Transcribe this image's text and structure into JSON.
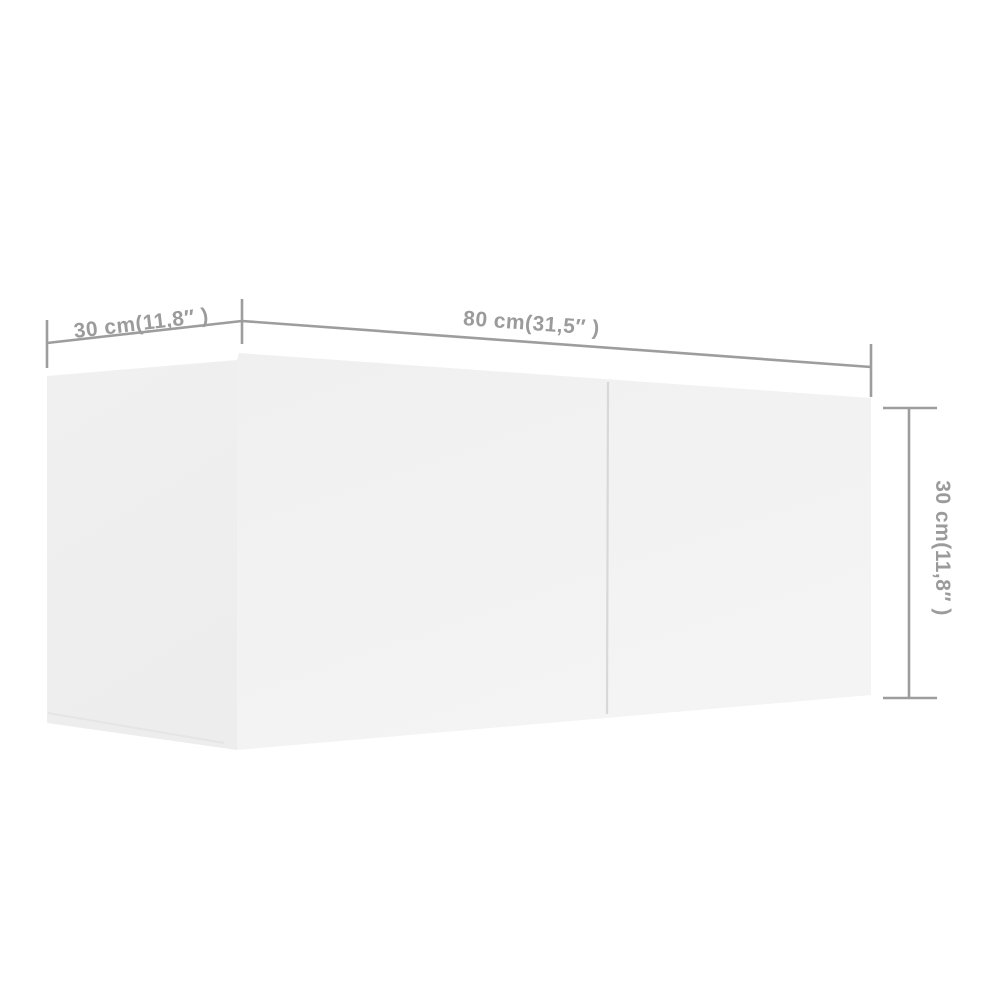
{
  "diagram": {
    "kind": "product-dimension-diagram",
    "dimensions": {
      "depth": {
        "label": "30 cm(11,8″ )",
        "cm": "30",
        "inches": "11,8"
      },
      "width": {
        "label": "80 cm(31,5″ )",
        "cm": "80",
        "inches": "31,5"
      },
      "height": {
        "label": "30 cm(11,8″ )",
        "cm": "30",
        "inches": "11,8"
      }
    },
    "colors": {
      "background": "#ffffff",
      "dimension_lines": "#9d9d9d",
      "dimension_text": "#9b9b9b",
      "cabinet_side_face": "#efefef",
      "cabinet_front_face": "#f2f2f2",
      "door_gap_line": "#d8d8d8",
      "bottom_edge_highlight": "#e3e3e3"
    }
  }
}
